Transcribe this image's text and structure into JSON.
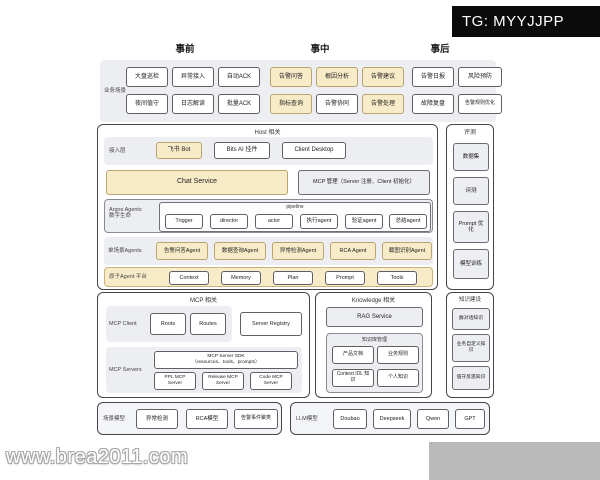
{
  "watermarks": {
    "tg": "TG: MYYJJPP",
    "site": "www.brea2011.com"
  },
  "phases": {
    "pre": "事前",
    "during": "事中",
    "post": "事后"
  },
  "business": {
    "label": "业务场景",
    "cells": [
      "大盘巡检",
      "异常接入",
      "自动ACK",
      "告警问答",
      "根因分析",
      "告警建议",
      "告警日报",
      "风险预防",
      "夜间值守",
      "日志解读",
      "批量ACK",
      "指标查询",
      "告警协同",
      "告警处理",
      "故障复盘",
      "告警规则优化"
    ]
  },
  "host": {
    "title": "Host 相关",
    "access": {
      "label": "接入层",
      "items": [
        "飞书 Bot",
        "Bits AI 挂件",
        "Client Desktop"
      ]
    },
    "chat_service": "Chat Service",
    "mcp_manage": "MCP 管理（Server 注册、Client 初始化）",
    "argos": {
      "label_line1": "Argos Agents",
      "label_line2": "数字生命",
      "pipeline_title": "pipeline",
      "items": [
        "Trigger",
        "director",
        "actor",
        "执行agent",
        "验证agent",
        "总结agent"
      ]
    },
    "single": {
      "label": "单场景Agents",
      "items": [
        "告警问答Agent",
        "数据查询Agent",
        "异常检测Agent",
        "RCA Agent",
        "截图识别Agent"
      ]
    },
    "atomic": {
      "label": "原子Agent 平台",
      "items": [
        "Context",
        "Memory",
        "Plan",
        "Prompt",
        "Tools"
      ]
    }
  },
  "evaluation": {
    "title": "评测",
    "items": [
      "数据集",
      "评测",
      "Prompt 优化",
      "模型训练"
    ]
  },
  "mcp": {
    "title": "MCP 相关",
    "client": {
      "label": "MCP Client",
      "items": [
        "Roots",
        "Routes"
      ]
    },
    "server_registry": "Server Registry",
    "servers": {
      "label": "MCP Servers",
      "sdk_line1": "MCP Server SDK",
      "sdk_line2": "（resources、tools、prompts）",
      "items": [
        "PPL MCP Server",
        "Release MCP Server",
        "Code MCP Server"
      ]
    }
  },
  "knowledge": {
    "title": "Knowledge 相关",
    "rag": "RAG Service",
    "kb": {
      "title": "知识库管理",
      "items": [
        "产品文档",
        "业务规则",
        "Context IDL 知识",
        "个人知识"
      ]
    }
  },
  "knowledge_build": {
    "title": "知识建设",
    "items": [
      "群对话知识",
      "业务自定义知识",
      "值守反思知识"
    ]
  },
  "scene_models": {
    "label": "场景模型",
    "items": [
      "异常检测",
      "RCA模型",
      "告警事件聚类"
    ]
  },
  "llm_models": {
    "label": "LLM模型",
    "items": [
      "Doubao",
      "Deepseek",
      "Qwen",
      "GPT"
    ]
  },
  "colors": {
    "accent_yellow": "#F8ECC8",
    "panel_gray": "#EDEEF2",
    "frame_border": "#45454C",
    "watermark_bg": "#0B0B0B"
  }
}
